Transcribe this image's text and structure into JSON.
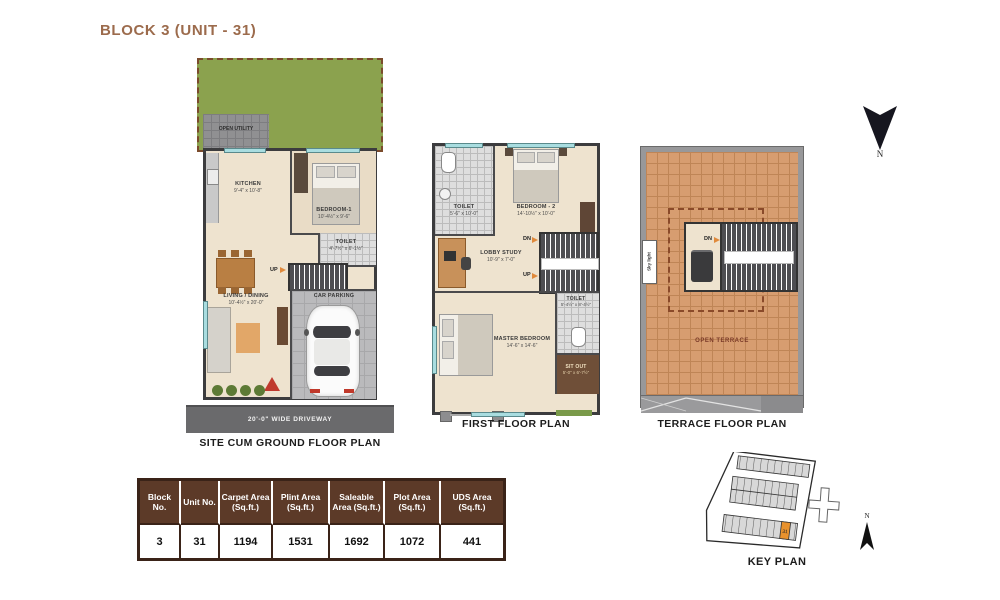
{
  "title": "BLOCK 3 (UNIT - 31)",
  "north_label": "N",
  "ground_floor": {
    "caption": "SITE CUM GROUND FLOOR PLAN",
    "open_utility_label": "OPEN UTILITY",
    "kitchen_name": "KITCHEN",
    "kitchen_dim": "9'-4\" x 10'-8\"",
    "bedroom1_name": "BEDROOM-1",
    "bedroom1_dim": "10'-4½\" x 9'-6\"",
    "toilet_name": "TOILET",
    "toilet_dim": "4'-7½\" x 6'-1½\"",
    "living_name": "LIVING / DINING",
    "living_dim": "10'-4½\" x 20'-0\"",
    "car_parking_label": "CAR PARKING",
    "up_label": "UP",
    "driveway_label": "20'-0\" WIDE DRIVEWAY"
  },
  "first_floor": {
    "caption": "FIRST FLOOR PLAN",
    "toilet1_name": "TOILET",
    "toilet1_dim": "5'-6\" x 10'-0\"",
    "bedroom2_name": "BEDROOM - 2",
    "bedroom2_dim": "14'-10½\" x 10'-0\"",
    "lobby_name": "LOBBY STUDY",
    "lobby_dim": "10'-9\" x 7'-0\"",
    "master_name": "MASTER BEDROOM",
    "master_dim": "14'-6\" x 14'-6\"",
    "toilet2_name": "TOILET",
    "toilet2_dim": "5'-4½\" x 8'-4½\"",
    "sitout_name": "SIT OUT",
    "sitout_dim": "5'-0\" x 6'-7½\"",
    "dn_label": "DN",
    "up_label": "UP"
  },
  "terrace_floor": {
    "caption": "TERRACE FLOOR PLAN",
    "open_terrace_label": "OPEN TERRACE",
    "skylight_label": "Sky light",
    "dn_label": "DN"
  },
  "area_table": {
    "headers": [
      "Block No.",
      "Unit No.",
      "Carpet Area (Sq.ft.)",
      "Plint Area (Sq.ft.)",
      "Saleable Area (Sq.ft.)",
      "Plot Area (Sq.ft.)",
      "UDS Area (Sq.ft.)"
    ],
    "values": [
      "3",
      "31",
      "1194",
      "1531",
      "1692",
      "1072",
      "441"
    ]
  },
  "key_plan": {
    "caption": "KEY PLAN",
    "highlighted_unit": "31",
    "north_label": "N"
  },
  "colors": {
    "accent_brown": "#9c6b4c",
    "table_header_brown": "#5c3a28",
    "floor_beige": "#eee3cf",
    "wall_dark": "#3c3c3e",
    "garden_green": "#8ba24e",
    "terrace_tile": "#d79d70",
    "highlight_orange": "#e8922e"
  }
}
